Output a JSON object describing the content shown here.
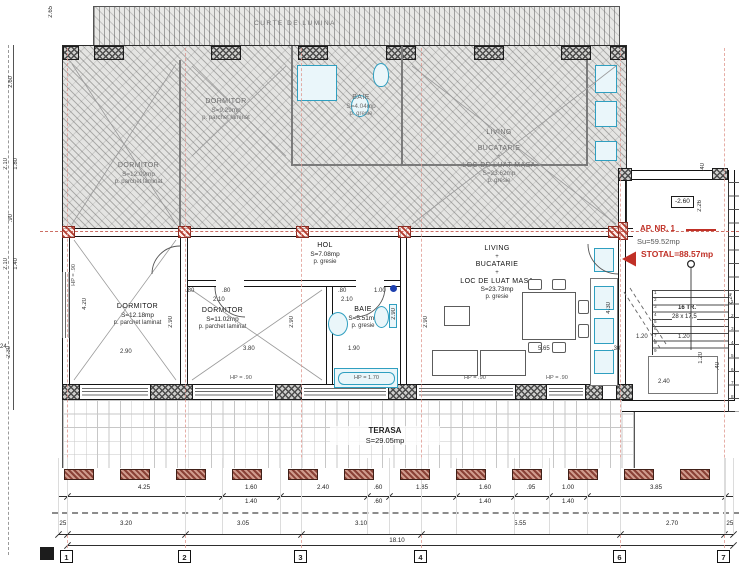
{
  "colors": {
    "red": "#c03026",
    "axis_pink": "#e09a92",
    "fixture_blue": "#2f9fc0",
    "post_brown": "#8a4136"
  },
  "upper_level": {
    "light_court_label": "CURTE DE LUMINA",
    "rooms": {
      "dormitor_left": {
        "name": "DORMITOR",
        "area": "S=12.09mp",
        "finish": "p. parchet laminat"
      },
      "dormitor_mid": {
        "name": "DORMITOR",
        "area": "S=9.29mp",
        "finish": "p. parchet laminat"
      },
      "baie": {
        "name": "BAIE",
        "area": "S=4.04mp",
        "finish": "p. gresie"
      },
      "living": {
        "line1": "LIVING",
        "plus1": "+",
        "line2": "BUCATARIE",
        "plus2": "+",
        "line3": "LOC DE LUAT MASA",
        "area": "S=23.62mp",
        "finish": "p. gresie"
      }
    }
  },
  "apartment": {
    "label": {
      "title": "AP. NR. 1",
      "useful_area": "Su=59.52mp",
      "total_area": "STOTAL=88.57mp"
    },
    "level_marker": "-2.60",
    "rooms": {
      "dormitor1": {
        "name": "DORMITOR",
        "area": "S=12.18mp",
        "finish": "p. parchet laminat"
      },
      "dormitor2": {
        "name": "DORMITOR",
        "area": "S=11.02mp",
        "finish": "p. parchet laminat"
      },
      "hol": {
        "name": "HOL",
        "area": "S=7.08mp",
        "finish": "p. gresie"
      },
      "baie": {
        "name": "BAIE",
        "area": "S=5.51mp",
        "finish": "p. gresie"
      },
      "living": {
        "line1": "LIVING",
        "plus1": "+",
        "line2": "BUCATARIE",
        "plus2": "+",
        "line3": "LOC DE LUAT MASA",
        "area": "S=23.73mp",
        "finish": "p. gresie"
      },
      "terasa": {
        "name": "TERASA",
        "area": "S=29.05mp"
      }
    },
    "stairs": {
      "count_note": "16 TR.",
      "step_note": "28 x 17,5",
      "tread_numbers": [
        "1",
        "2",
        "3",
        "4",
        "5",
        "6",
        "7",
        "8",
        "9"
      ],
      "side_tread_numbers": [
        "1",
        "2",
        "3",
        "4",
        "5",
        "6",
        "7",
        "8"
      ]
    }
  },
  "windows": {
    "labels": [
      {
        "t": "HP = .90",
        "x": 230,
        "y": 376
      },
      {
        "t": "HP = 1.70",
        "x": 354,
        "y": 376
      },
      {
        "t": "HP = .90",
        "x": 464,
        "y": 376
      },
      {
        "t": "HP = .90",
        "x": 546,
        "y": 376
      },
      {
        "t": "HP = .90",
        "x": 72,
        "y": 264,
        "r": 1
      }
    ]
  },
  "dimensions": {
    "row1": {
      "items": [
        {
          "a": "4.25",
          "x": 144
        },
        {
          "a": "1.60",
          "b": "1.40",
          "x": 251
        },
        {
          "a": "2.40",
          "x": 323
        },
        {
          "a": ".60",
          "b": ".60",
          "x": 378
        },
        {
          "a": "1.85",
          "x": 422
        },
        {
          "a": "1.60",
          "b": "1.40",
          "x": 485
        },
        {
          "a": ".95",
          "x": 531
        },
        {
          "a": "1.00",
          "b": "1.40",
          "x": 568
        },
        {
          "a": "3.85",
          "x": 656
        }
      ],
      "ticks": [
        67,
        222,
        280,
        367,
        389,
        456,
        514,
        549,
        587,
        725
      ]
    },
    "row2": {
      "items": [
        {
          "a": ".25",
          "x": 62
        },
        {
          "a": "3.20",
          "x": 126
        },
        {
          "a": "3.05",
          "x": 243
        },
        {
          "a": "3.10",
          "x": 361
        },
        {
          "a": "5.55",
          "x": 520
        },
        {
          "a": "2.70",
          "x": 672
        },
        {
          "a": ".25",
          "x": 729
        }
      ],
      "ticks": [
        58,
        67,
        185,
        301,
        421,
        620,
        724,
        733
      ]
    },
    "total": {
      "t": "18.10"
    },
    "annotations": [
      {
        "t": ".80",
        "x": 186,
        "y": 288
      },
      {
        "t": ".80",
        "x": 222,
        "y": 288
      },
      {
        "t": "2.10",
        "x": 213,
        "y": 297
      },
      {
        "t": ".80",
        "x": 338,
        "y": 288
      },
      {
        "t": "2.10",
        "x": 341,
        "y": 297
      },
      {
        "t": "1.00",
        "x": 374,
        "y": 288
      },
      {
        "t": "1.90",
        "x": 348,
        "y": 346
      },
      {
        "t": "3.80",
        "x": 243,
        "y": 346
      },
      {
        "t": "2.90",
        "x": 120,
        "y": 349
      },
      {
        "t": "5.65",
        "x": 538,
        "y": 346
      },
      {
        "t": "4.20",
        "x": 82,
        "y": 298,
        "r": 1
      },
      {
        "t": "2.90",
        "x": 168,
        "y": 316,
        "r": 1
      },
      {
        "t": "2.90",
        "x": 289,
        "y": 316,
        "r": 1
      },
      {
        "t": "2.90",
        "x": 391,
        "y": 308,
        "r": 1
      },
      {
        "t": "2.90",
        "x": 423,
        "y": 316,
        "r": 1
      },
      {
        "t": "4.30",
        "x": 606,
        "y": 302,
        "r": 1
      },
      {
        "t": "2.26",
        "x": 697,
        "y": 200,
        "r": 1
      },
      {
        "t": ".40",
        "x": 700,
        "y": 163,
        "r": 1
      },
      {
        "t": "2.24",
        "x": 728,
        "y": 293,
        "r": 1
      },
      {
        "t": "1.20",
        "x": 636,
        "y": 334
      },
      {
        "t": "1.20",
        "x": 678,
        "y": 334
      },
      {
        "t": "1.20",
        "x": 698,
        "y": 352,
        "r": 1
      },
      {
        "t": "2.40",
        "x": 658,
        "y": 379
      },
      {
        "t": ".40",
        "x": 715,
        "y": 362,
        "r": 1
      },
      {
        "t": ".30",
        "x": 612,
        "y": 346
      },
      {
        "t": "2.65",
        "x": 48,
        "y": 6,
        "r": 1
      },
      {
        "t": "2.60",
        "x": 8,
        "y": 76,
        "r": 1
      },
      {
        "t": "2.10",
        "x": 3,
        "y": 158,
        "r": 1
      },
      {
        "t": "1.80",
        "x": 13,
        "y": 158,
        "r": 1
      },
      {
        "t": ".90",
        "x": 8,
        "y": 214,
        "r": 1
      },
      {
        "t": "2.10",
        "x": 3,
        "y": 258,
        "r": 1
      },
      {
        "t": "1.40",
        "x": 13,
        "y": 258,
        "r": 1
      },
      {
        "t": "2.30",
        "x": 6,
        "y": 346,
        "r": 1
      },
      {
        "t": "24",
        "x": 0,
        "y": 344
      }
    ]
  },
  "grid_axes": {
    "bubbles": [
      {
        "n": "1",
        "x": 67
      },
      {
        "n": "2",
        "x": 185
      },
      {
        "n": "3",
        "x": 301
      },
      {
        "n": "4",
        "x": 421
      },
      {
        "n": "6",
        "x": 620
      },
      {
        "n": "7",
        "x": 724
      }
    ],
    "xs": [
      67,
      185,
      301,
      421,
      620,
      724
    ]
  }
}
